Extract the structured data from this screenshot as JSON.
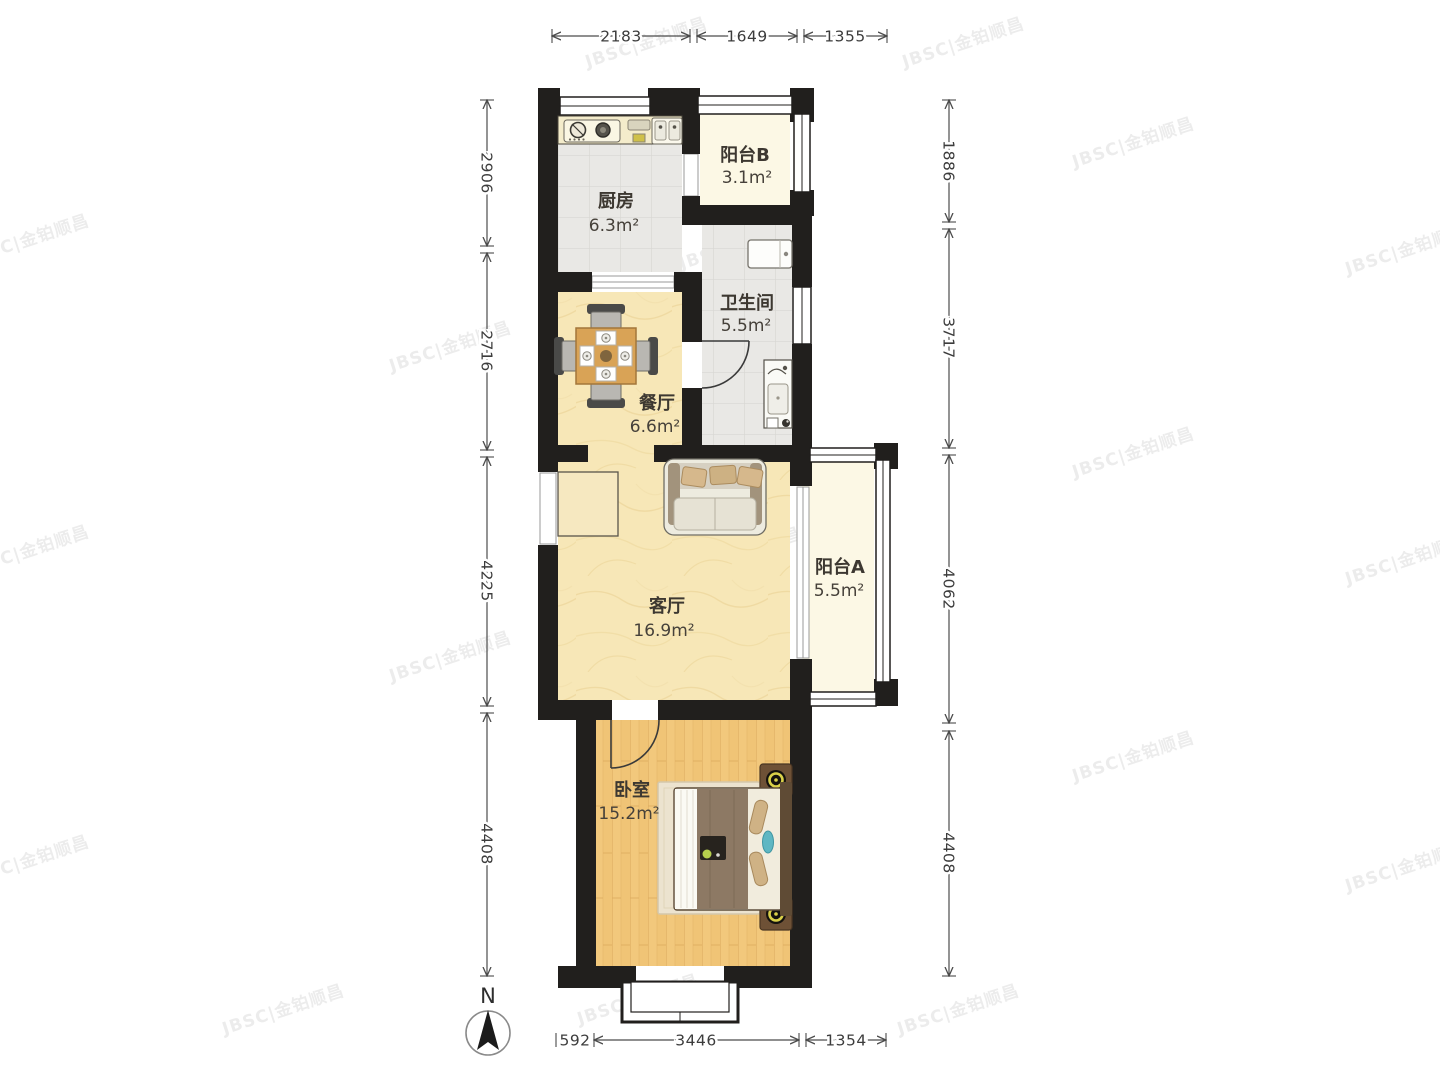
{
  "plan_type": "floorplan",
  "watermark": {
    "text": "JBSC|金铂顺昌"
  },
  "compass": {
    "north_label": "N"
  },
  "rooms": [
    {
      "id": "kitchen",
      "name": "厨房",
      "area": "6.3m²"
    },
    {
      "id": "balcony-b",
      "name": "阳台B",
      "area": "3.1m²"
    },
    {
      "id": "bathroom",
      "name": "卫生间",
      "area": "5.5m²"
    },
    {
      "id": "dining",
      "name": "餐厅",
      "area": "6.6m²"
    },
    {
      "id": "living",
      "name": "客厅",
      "area": "16.9m²"
    },
    {
      "id": "balcony-a",
      "name": "阳台A",
      "area": "5.5m²"
    },
    {
      "id": "bedroom",
      "name": "卧室",
      "area": "15.2m²"
    }
  ],
  "dimensions": {
    "top": [
      "2183",
      "1649",
      "1355"
    ],
    "left": [
      "2906",
      "2716",
      "4225",
      "4408"
    ],
    "right": [
      "1886",
      "3717",
      "4062",
      "4408"
    ],
    "bottom": [
      "592",
      "3446",
      "1354"
    ]
  },
  "colors": {
    "wall": "#211f1d",
    "floor_marble": "#f7e7b7",
    "floor_wood": "#f2c87c",
    "floor_tile": "#e9e8e5",
    "floor_balcony": "#fcf8e5",
    "dimension_line": "#4c4c4c",
    "table_wood": "#d9a356",
    "lamp_ring": "#d9d049",
    "pillow_teal": "#5fb7c3"
  }
}
